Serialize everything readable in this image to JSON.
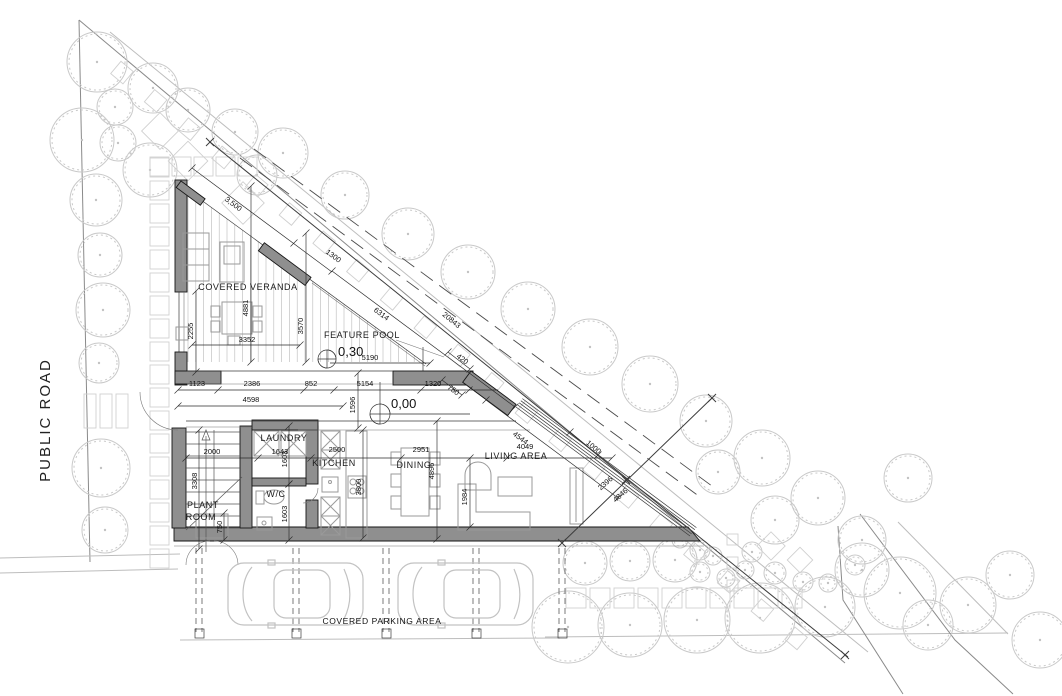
{
  "drawing": "architectural site and ground floor plan",
  "colors": {
    "wall_fill": "#8f8f8f",
    "site_line": "#bdbdbd",
    "tree_line": "#c9c9c9",
    "text": "#111111"
  },
  "site_labels": {
    "public_road": {
      "t": "PUBLIC ROAD",
      "x": 50,
      "y": 420,
      "rot": -90
    },
    "covered_parking": {
      "t": "COVERED PARKING AREA",
      "x": 382,
      "y": 624
    }
  },
  "room_labels": {
    "covered_veranda": {
      "t": "COVERED VERANDA",
      "x": 248,
      "y": 290
    },
    "feature_pool": {
      "t": "FEATURE POOL",
      "x": 362,
      "y": 338
    },
    "laundry": {
      "t": "LAUNDRY",
      "x": 284,
      "y": 441
    },
    "kitchen": {
      "t": "KITCHEN",
      "x": 334,
      "y": 466
    },
    "dining": {
      "t": "DINING",
      "x": 414,
      "y": 468
    },
    "living_area": {
      "t": "LIVING AREA",
      "x": 516,
      "y": 459
    },
    "wc": {
      "t": "W/C",
      "x": 276,
      "y": 497
    },
    "plant_room": {
      "lines": [
        "PLANT",
        "ROOM"
      ],
      "x": 203,
      "y": 508
    }
  },
  "levels": [
    {
      "value": "0,30",
      "marker_x": 327,
      "marker_y": 359,
      "text_x": 338,
      "text_y": 356
    },
    {
      "value": "0,00",
      "marker_x": 380,
      "marker_y": 414,
      "text_x": 391,
      "text_y": 408
    }
  ],
  "dims": [
    {
      "t": "3,500",
      "x": 232,
      "y": 206,
      "r": 36.5
    },
    {
      "t": "1300",
      "x": 332,
      "y": 258,
      "r": 36.5
    },
    {
      "t": "6314",
      "x": 380,
      "y": 316,
      "r": 36.5
    },
    {
      "t": "20843",
      "x": 450,
      "y": 322,
      "r": 39
    },
    {
      "t": "2255",
      "x": 193,
      "y": 331,
      "r": -90
    },
    {
      "t": "4881",
      "x": 248,
      "y": 308,
      "r": -90
    },
    {
      "t": "3352",
      "x": 247,
      "y": 342,
      "r": 0
    },
    {
      "t": "3570",
      "x": 303,
      "y": 326,
      "r": -90
    },
    {
      "t": "5190",
      "x": 370,
      "y": 360,
      "r": 0
    },
    {
      "t": "1123",
      "x": 197,
      "y": 386,
      "r": 0
    },
    {
      "t": "2386",
      "x": 252,
      "y": 386,
      "r": 0
    },
    {
      "t": "852",
      "x": 311,
      "y": 386,
      "r": 0
    },
    {
      "t": "5154",
      "x": 365,
      "y": 386,
      "r": 0
    },
    {
      "t": "1320",
      "x": 433,
      "y": 386,
      "r": 0
    },
    {
      "t": "420",
      "x": 461,
      "y": 361,
      "r": 36.5
    },
    {
      "t": "750",
      "x": 452,
      "y": 392,
      "r": 36.5
    },
    {
      "t": "4598",
      "x": 251,
      "y": 402,
      "r": 0
    },
    {
      "t": "1596",
      "x": 355,
      "y": 405,
      "r": -90
    },
    {
      "t": "2000",
      "x": 212,
      "y": 454,
      "r": 0
    },
    {
      "t": "1643",
      "x": 280,
      "y": 454,
      "r": 0
    },
    {
      "t": "2500",
      "x": 337,
      "y": 452,
      "r": 0
    },
    {
      "t": "2951",
      "x": 421,
      "y": 452,
      "r": 0
    },
    {
      "t": "4049",
      "x": 525,
      "y": 449,
      "r": 0
    },
    {
      "t": "4544",
      "x": 519,
      "y": 440,
      "r": 36.5
    },
    {
      "t": "1000",
      "x": 592,
      "y": 449,
      "r": 40
    },
    {
      "t": "2396",
      "x": 607,
      "y": 485,
      "r": -41
    },
    {
      "t": "4846",
      "x": 622,
      "y": 497,
      "r": -41
    },
    {
      "t": "1984",
      "x": 467,
      "y": 497,
      "r": -90
    },
    {
      "t": "4896",
      "x": 434,
      "y": 471,
      "r": -90
    },
    {
      "t": "3800",
      "x": 361,
      "y": 487,
      "r": -90
    },
    {
      "t": "1603",
      "x": 287,
      "y": 459,
      "r": -90
    },
    {
      "t": "1603",
      "x": 287,
      "y": 514,
      "r": -90
    },
    {
      "t": "3308",
      "x": 197,
      "y": 481,
      "r": -90
    },
    {
      "t": "750",
      "x": 222,
      "y": 527,
      "r": -90
    }
  ],
  "site": {
    "trees": [
      [
        97,
        62,
        30
      ],
      [
        82,
        140,
        32
      ],
      [
        118,
        143,
        18
      ],
      [
        96,
        200,
        26
      ],
      [
        100,
        255,
        22
      ],
      [
        103,
        310,
        27
      ],
      [
        99,
        363,
        20
      ],
      [
        101,
        468,
        29
      ],
      [
        105,
        530,
        23
      ],
      [
        153,
        88,
        25
      ],
      [
        115,
        107,
        18
      ],
      [
        150,
        170,
        27
      ],
      [
        188,
        110,
        22
      ],
      [
        235,
        132,
        23
      ],
      [
        283,
        153,
        25
      ],
      [
        257,
        175,
        20
      ],
      [
        345,
        195,
        24
      ],
      [
        408,
        234,
        26
      ],
      [
        468,
        272,
        27
      ],
      [
        528,
        309,
        27
      ],
      [
        590,
        347,
        28
      ],
      [
        650,
        384,
        28
      ],
      [
        706,
        421,
        26
      ],
      [
        762,
        458,
        28
      ],
      [
        818,
        498,
        27
      ],
      [
        862,
        540,
        24
      ],
      [
        718,
        472,
        22
      ],
      [
        775,
        520,
        24
      ],
      [
        908,
        478,
        24
      ],
      [
        585,
        563,
        22
      ],
      [
        630,
        561,
        20
      ],
      [
        675,
        560,
        22
      ],
      [
        568,
        627,
        36
      ],
      [
        630,
        625,
        32
      ],
      [
        697,
        620,
        33
      ],
      [
        760,
        618,
        35
      ],
      [
        825,
        607,
        30
      ],
      [
        862,
        570,
        27
      ],
      [
        900,
        593,
        36
      ],
      [
        928,
        625,
        25
      ],
      [
        968,
        605,
        28
      ],
      [
        1010,
        575,
        24
      ],
      [
        1040,
        640,
        28
      ],
      [
        700,
        550,
        10
      ],
      [
        713,
        556,
        9
      ],
      [
        752,
        552,
        10
      ],
      [
        775,
        573,
        11
      ],
      [
        803,
        582,
        10
      ],
      [
        828,
        583,
        9
      ],
      [
        700,
        572,
        10
      ],
      [
        726,
        578,
        9
      ],
      [
        680,
        540,
        8
      ],
      [
        745,
        570,
        9
      ],
      [
        855,
        565,
        10
      ]
    ],
    "parking_columns_x": [
      199,
      296,
      386,
      476,
      562
    ],
    "cars": [
      [
        228,
        563
      ],
      [
        398,
        563
      ]
    ]
  }
}
